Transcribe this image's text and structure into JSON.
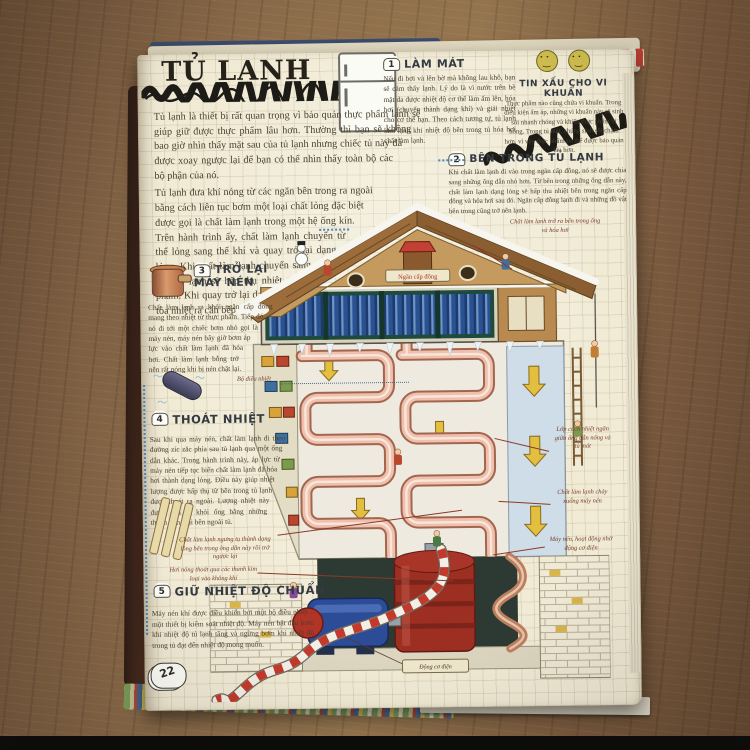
{
  "book": {
    "page_number": "22",
    "title": "TỦ LẠNH",
    "intro": {
      "p1": "Tủ lạnh là thiết bị rất quan trọng vì bảo quản thực phẩm lạnh sẽ giúp giữ được thực phẩm lâu hơn. Thường thì bạn sẽ không bao giờ nhìn thấy mặt sau của tủ lạnh nhưng chiếc tủ này đã được xoay ngược lại để bạn có thể nhìn thấy toàn bộ các bộ phận của nó.",
      "p2": "Tủ lạnh đưa khí nóng từ các ngăn bên trong ra ngoài bằng cách liên tục bơm một loại chất lỏng đặc biệt được gọi là chất làm lạnh trong một hệ ống kín. Trên hành trình ấy, chất làm lạnh chuyển từ thể lỏng sang thể khí và quay trở lại dạng lỏng. Khi chất làm lạnh chuyển sang thể khí, tủ lạnh sẽ hấp thụ nhiệt từ thực phẩm. Khi quay trở lại dạng lỏng, nó tỏa nhiệt ra căn bếp nhà bạn."
    },
    "sections": [
      {
        "num": "1",
        "heading": "LÀM MÁT",
        "body": "Nếu đi bơi và lên bờ mà không lau khô, bạn sẽ cảm thấy lạnh. Lý do là vì nước trên bề mặt da được nhiệt độ cơ thể làm ấm lên, hóa hơi (chuyển thành dạng khí) và giải nhiệt cho cơ thể bạn. Theo cách tương tự, tủ lạnh làm lạnh khi nhiệt độ bên trong tủ hóa hơi chất làm lạnh."
      },
      {
        "num": "2",
        "heading": "BÊN TRONG TỦ LẠNH",
        "body": "Khi chất làm lạnh đi vào trong ngăn cấp đông, nó sẽ được chia sang những ống dẫn nhỏ hơn. Từ bên trong những ống dẫn này, chất làm lạnh dạng lỏng sẽ hấp thu nhiệt bên trong ngăn cấp đông và hóa hơi sau đó. Ngăn cấp đông lạnh đi và những đồ vật bên trong cũng trở nên lạnh."
      },
      {
        "num": "3",
        "heading": "TRỞ LẠI MÁY NÉN",
        "body": "Chất làm lạnh ra khỏi ngăn cấp đông mang theo nhiệt từ thực phẩm. Tiếp đó, nó đi tới một chiếc bơm nhỏ gọi là máy nén, máy nén bây giờ bơm áp lực vào chất làm lạnh đã hóa hơi. Chất làm lạnh bỗng trở nên rất nóng khi bị nén chặt lại."
      },
      {
        "num": "4",
        "heading": "THOÁT NHIỆT",
        "body": "Sau khi qua máy nén, chất làm lạnh đi theo đường zíc zắc phía sau tủ lạnh qua một ống dẫn khác. Trong hành trình này, áp lực từ máy nén tiếp tục biến chất làm lạnh đã hóa hơi thành dạng lỏng. Điều này giúp nhiệt lượng được hấp thụ từ bên trong tủ lạnh được thoát ra ngoài. Lượng nhiệt này được đưa ra khỏi ống bằng những thanh kim loại bên ngoài tủ."
      },
      {
        "num": "5",
        "heading": "GIỮ NHIỆT ĐỘ CHUẨN",
        "body": "Máy nén khí được điều khiển bởi một bộ điều nhiệt – một thiết bị kiểm soát nhiệt độ. Máy nén bắt đầu bơm khi nhiệt độ tủ lạnh tăng và ngừng bơm khi nhiệt độ trong tủ đạt đến nhiệt độ mong muốn."
      }
    ],
    "tip_box": {
      "heading": "TIN XẤU CHO VI KHUẨN",
      "body": "Thực phẩm nào cũng chứa vi khuẩn. Trong điều kiện ấm áp, những vi khuẩn này sẽ sinh sôi nhanh chóng và khiến thực phẩm bị hỏng. Trong tủ mát, chúng sinh sôi chậm hơn, vì vậy thực phẩm có thể được bảo quản lâu hơn."
    },
    "labels": {
      "refrigerant_out": "Chất làm lạnh trở ra bên trong ống và hóa hơi",
      "thermostat": "Bộ điều nhiệt",
      "condense": "Chất làm lạnh ngưng tụ thành dạng lỏng bên trong ống dẫn này rồi trở ngược lại",
      "heat_out": "Hơi nóng thoát qua các thanh kim loại vào không khí",
      "insulation": "Lớp cách nhiệt ngăn giữa ống dẫn nóng và tủ mát",
      "flow_down": "Chất làm lạnh chảy xuống máy nén",
      "compressor_motor": "Máy nén, hoạt động nhờ động cơ điện",
      "motor": "Động cơ điện",
      "freezer_sign": "Ngăn cấp đông"
    }
  }
}
